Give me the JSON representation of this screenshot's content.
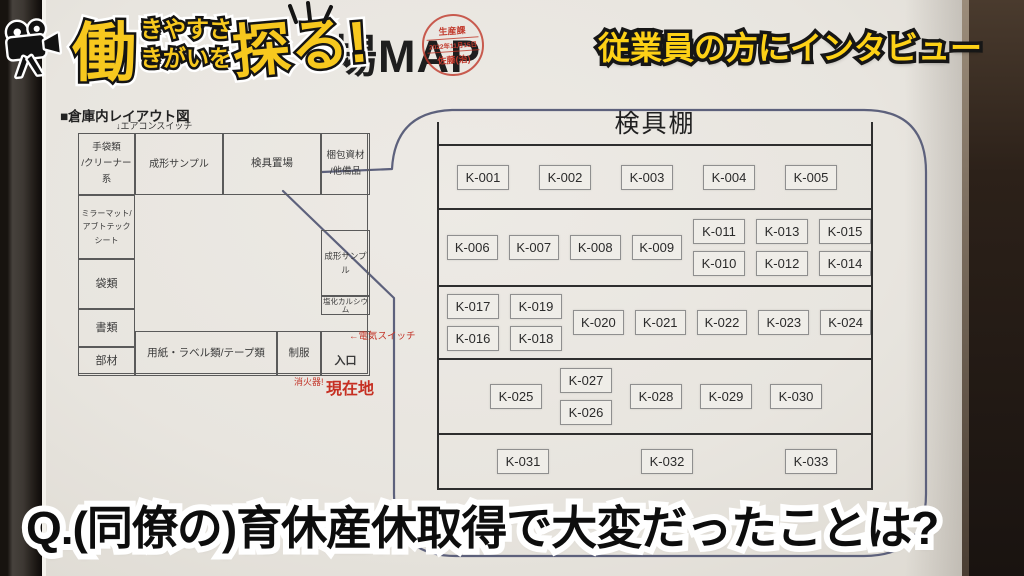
{
  "logo": {
    "icon": "film-camera-icon",
    "main_char": "働",
    "stack_top": "きやすさ",
    "stack_bottom": "きがいを",
    "tail": "探る!"
  },
  "header": {
    "map_title_visible": "場MAP",
    "stamp": {
      "department": "生産課",
      "date": "2022年11月15日",
      "name": "佐藤(治)"
    }
  },
  "captions": {
    "top_right": "従業員の方にインタビュー",
    "bottom_question": "Q.(同僚の)育休産休取得で大変だったことは?"
  },
  "layout_map": {
    "heading": "■倉庫内レイアウト図",
    "aircon_switch": "↓エアコンスイッチ",
    "cells": {
      "gloves": "手袋類\n/クリーナー系",
      "mirror_mat": "ミラーマット/\nアブトテックシート",
      "bags": "袋類",
      "documents": "書類",
      "parts": "部材",
      "molding_sample_top": "成形サンプル",
      "inspection_tool_area": "検具置場",
      "packing_material": "梱包資材\n/他備品",
      "molding_sample_right": "成形サンプル",
      "calcium_chloride": "塩化カルシウム",
      "paper_labels_tape": "用紙・ラベル類/テープ類",
      "uniform": "制服",
      "entrance": "入口"
    },
    "annotations": {
      "electric_switch": "←電気スイッチ",
      "fire_extinguisher": "消火器!",
      "current_location": "現在地"
    }
  },
  "shelf": {
    "title": "検具棚",
    "rows": [
      {
        "items": [
          {
            "t": "s",
            "label": "K-001"
          },
          {
            "t": "s",
            "label": "K-002"
          },
          {
            "t": "s",
            "label": "K-003"
          },
          {
            "t": "s",
            "label": "K-004"
          },
          {
            "t": "s",
            "label": "K-005"
          }
        ]
      },
      {
        "items": [
          {
            "t": "s",
            "label": "K-006"
          },
          {
            "t": "s",
            "label": "K-007"
          },
          {
            "t": "s",
            "label": "K-008"
          },
          {
            "t": "s",
            "label": "K-009"
          },
          {
            "t": "p",
            "top": "K-011",
            "bottom": "K-010"
          },
          {
            "t": "p",
            "top": "K-013",
            "bottom": "K-012"
          },
          {
            "t": "p",
            "top": "K-015",
            "bottom": "K-014"
          }
        ]
      },
      {
        "items": [
          {
            "t": "p",
            "top": "K-017",
            "bottom": "K-016"
          },
          {
            "t": "p",
            "top": "K-019",
            "bottom": "K-018"
          },
          {
            "t": "s",
            "label": "K-020"
          },
          {
            "t": "s",
            "label": "K-021"
          },
          {
            "t": "s",
            "label": "K-022"
          },
          {
            "t": "s",
            "label": "K-023"
          },
          {
            "t": "s",
            "label": "K-024"
          }
        ]
      },
      {
        "items": [
          {
            "t": "s",
            "label": "K-025"
          },
          {
            "t": "p",
            "top": "K-027",
            "bottom": "K-026"
          },
          {
            "t": "s",
            "label": "K-028"
          },
          {
            "t": "s",
            "label": "K-029"
          },
          {
            "t": "s",
            "label": "K-030"
          }
        ]
      },
      {
        "items": [
          {
            "t": "s",
            "label": "K-031"
          },
          {
            "t": "s",
            "label": "K-032"
          },
          {
            "t": "s",
            "label": "K-033"
          }
        ]
      }
    ]
  },
  "colors": {
    "accent_yellow": "#f7c81e",
    "stamp_red": "#c23b2e",
    "annotation_red": "#c3362a",
    "bubble_line": "#5d617c"
  }
}
